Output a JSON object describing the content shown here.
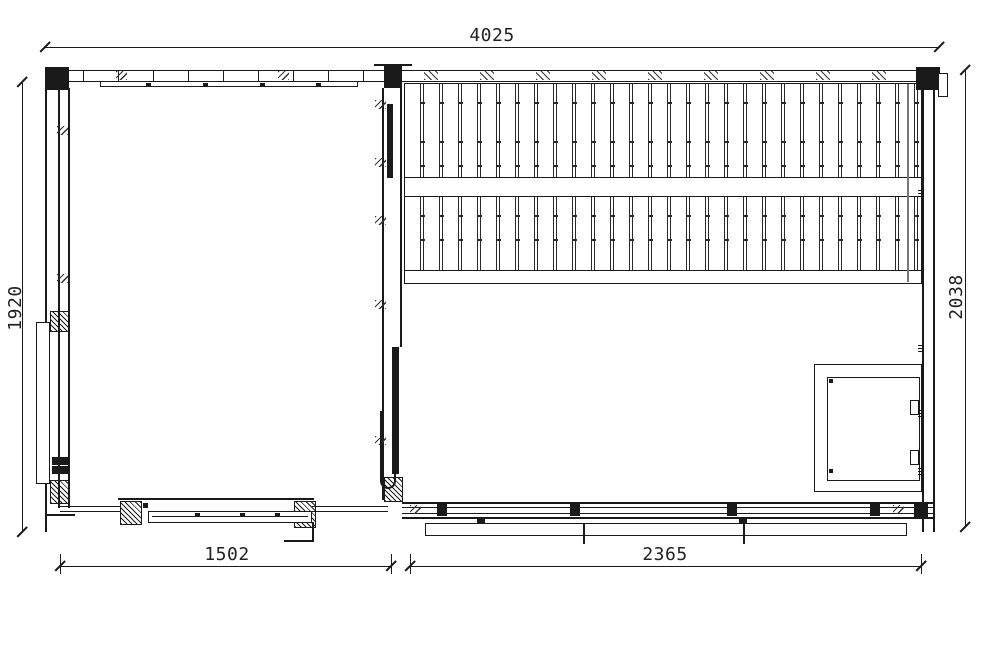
{
  "drawing": {
    "background": "#ffffff",
    "line_color": "#1a1a1a",
    "dimensions": {
      "overall_width": "4025",
      "left_side_height": "1920",
      "right_side_height": "2038",
      "left_room_width": "1502",
      "right_room_width": "2365"
    }
  }
}
